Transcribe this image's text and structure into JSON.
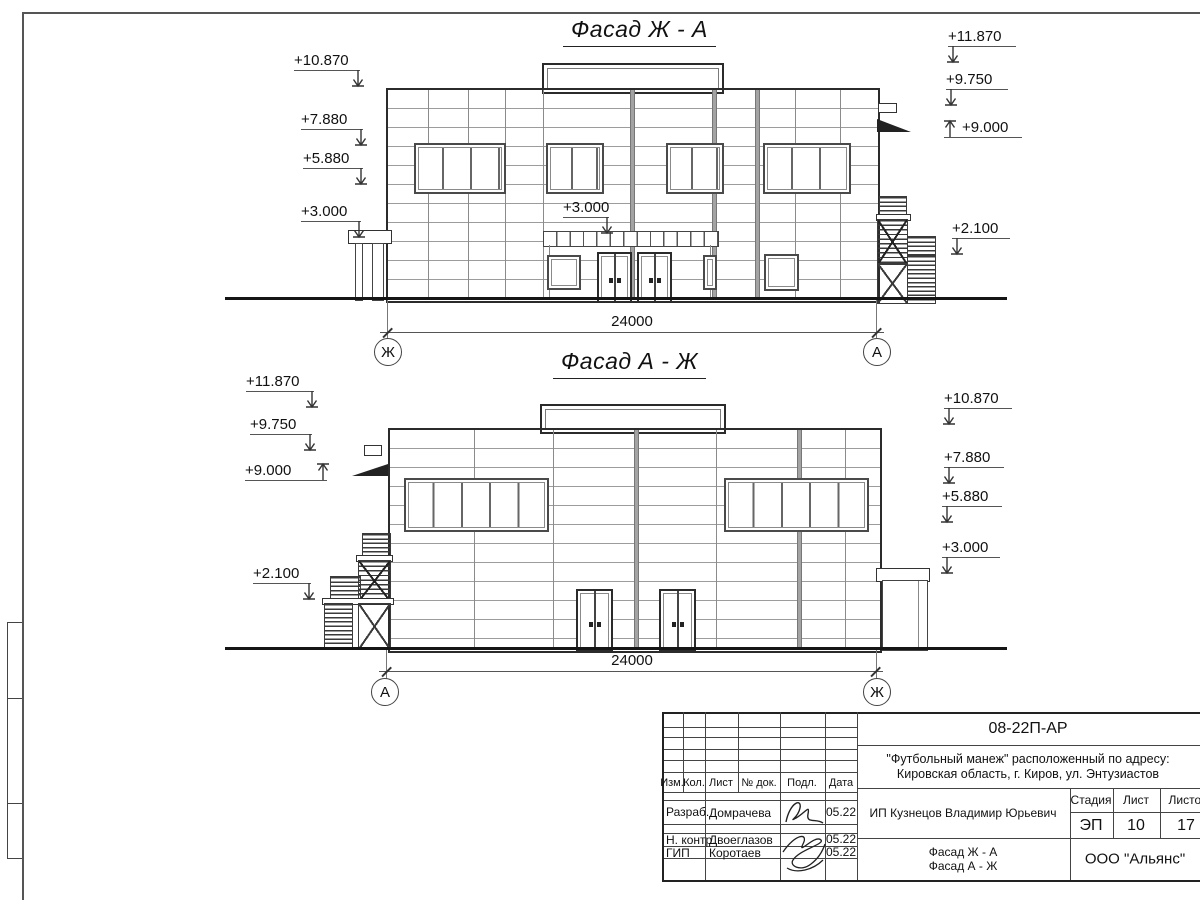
{
  "facade_top": {
    "title": "Фасад Ж - А",
    "marks_left": [
      "+10.870",
      "+7.880",
      "+5.880",
      "+3.000"
    ],
    "marks_right": [
      "+11.870",
      "+9.750",
      "+9.000",
      "+2.100"
    ],
    "center_mark": "+3.000",
    "dimension": "24000",
    "axis_left": "Ж",
    "axis_right": "А"
  },
  "facade_bottom": {
    "title": "Фасад А - Ж",
    "marks_left": [
      "+11.870",
      "+9.750",
      "+9.000",
      "+2.100"
    ],
    "marks_right": [
      "+10.870",
      "+7.880",
      "+5.880",
      "+3.000"
    ],
    "dimension": "24000",
    "axis_left": "А",
    "axis_right": "Ж"
  },
  "title_block": {
    "doc_number": "08-22П-АР",
    "project_address_line1": "\"Футбольный манеж\" расположенный по адресу:",
    "project_address_line2": "Кировская область, г. Киров, ул. Энтузиастов",
    "columns": [
      "Изм.",
      "Кол.",
      "Лист",
      "№ док.",
      "Подл.",
      "Дата"
    ],
    "rows": [
      {
        "role": "Разраб.",
        "name": "Домрачева",
        "date": "05.22"
      },
      {
        "role": "Н. контр.",
        "name": "Двоеглазов",
        "date": "05.22"
      },
      {
        "role": "ГИП",
        "name": "Коротаев",
        "date": "05.22"
      }
    ],
    "client": "ИП Кузнецов Владимир Юрьевич",
    "stage_label": "Стадия",
    "sheet_label": "Лист",
    "sheets_label": "Листов",
    "stage": "ЭП",
    "sheet_number": "10",
    "sheets_total": "17",
    "drawing_title_line1": "Фасад Ж - А",
    "drawing_title_line2": "Фасад А - Ж",
    "company": "ООО \"Альянс\""
  }
}
